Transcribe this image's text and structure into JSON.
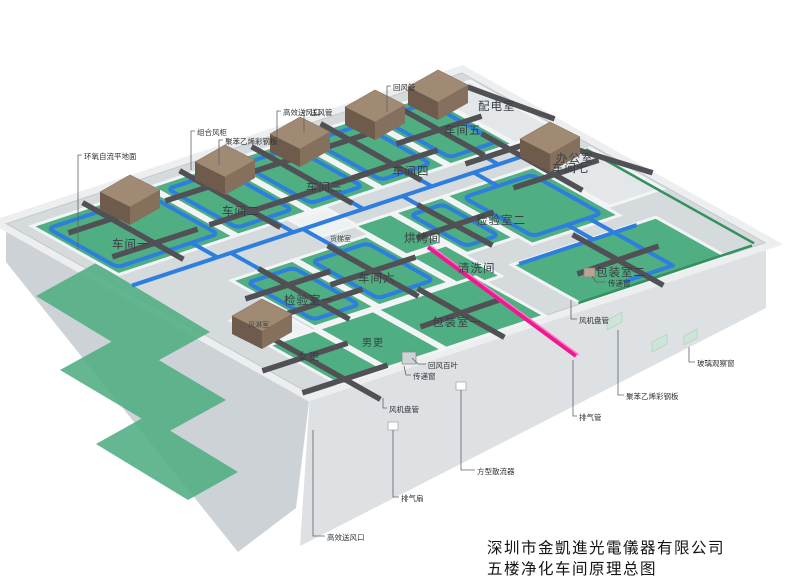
{
  "title": {
    "company": "深圳市金凱進光電儀器有限公司",
    "drawing": "五楼净化车间原理总图"
  },
  "rooms": {
    "ws1": "车间一",
    "ws2": "车间二",
    "ws3": "车间三",
    "ws4": "车间四",
    "ws5": "车间五",
    "ws6": "车间六",
    "ws7": "车间七",
    "insp1": "检验室一",
    "insp2": "检验室二",
    "pack1": "包装室一",
    "pack2": "包装室二",
    "clean": "清洗间",
    "bake": "烘烤间",
    "office": "办公室",
    "power": "配电室",
    "lift": "货梯室",
    "shower": "风淋室",
    "men": "男更",
    "women": "女更"
  },
  "callouts": {
    "epoxy_floor": "环氧自流平地面",
    "ahu_cabinet": "组合风柜",
    "steel_panel": "聚苯乙烯彩钢板",
    "hepa_outlet": "高效送风口",
    "supply_duct": "送风管",
    "return_duct": "回风管",
    "pass_window": "传递窗",
    "fan_coil": "风机盘管",
    "glass_window": "玻璃观察窗",
    "exhaust_duct": "排气管",
    "return_louver": "回风百叶",
    "square_diffuser": "方型散流器",
    "exhaust_fan": "排气扇"
  },
  "colors": {
    "background": "#ffffff",
    "floor_green": "#4fae82",
    "slab_gray": "#d5dadd",
    "wall_light": "#eceef0",
    "duct_blue": "#2e7ede",
    "duct_dark": "#515155",
    "ahu_brown": "#9a8470",
    "exhaust_pink": "#ec1a90",
    "green_strip": "#35905f"
  }
}
